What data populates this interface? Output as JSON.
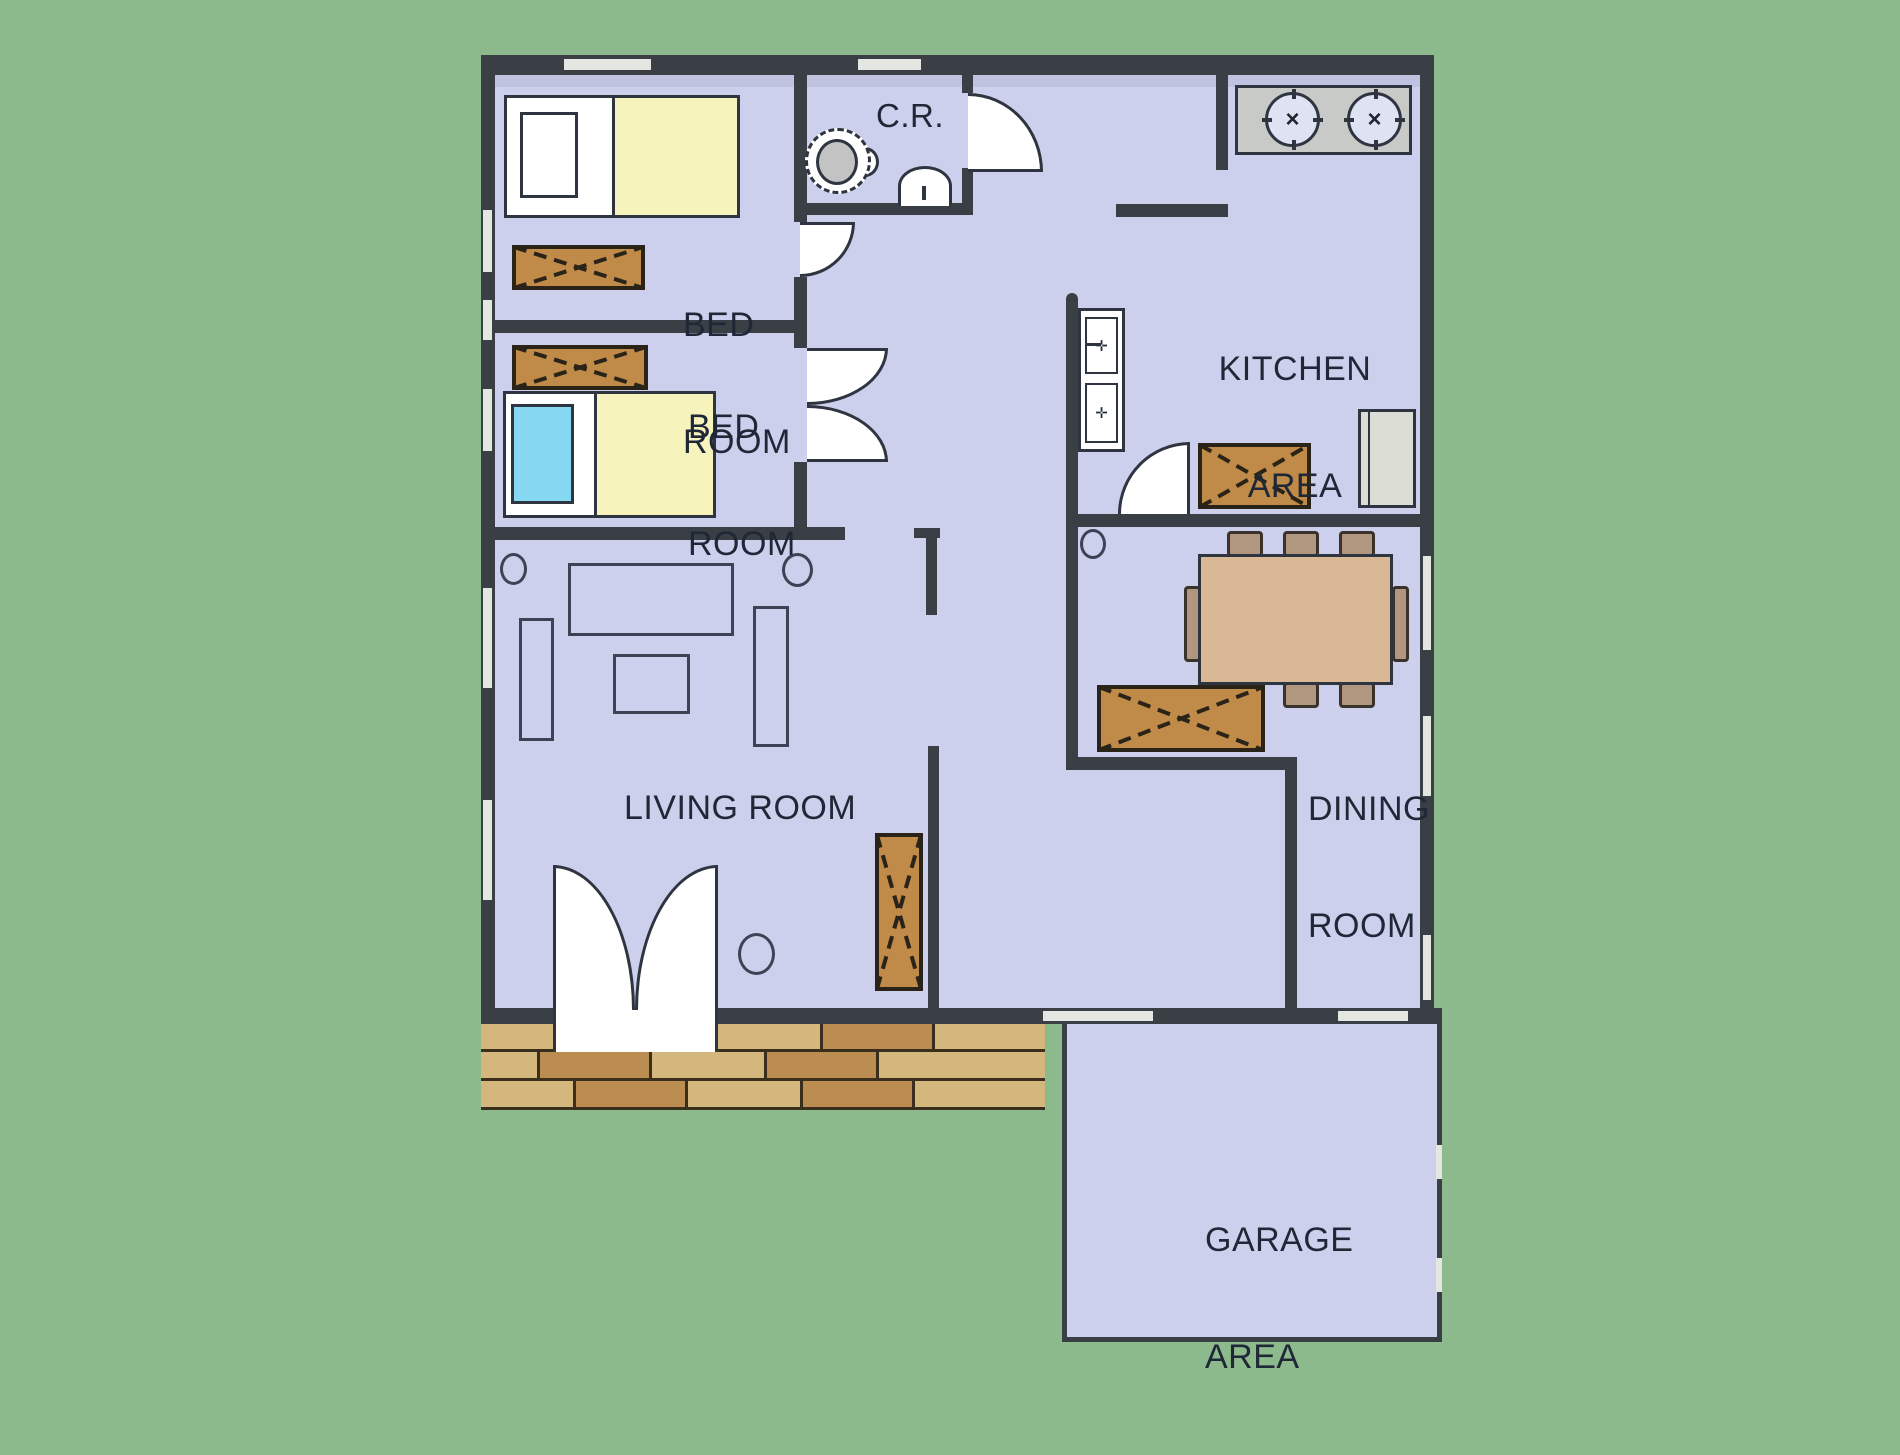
{
  "labels": {
    "bedroom1": {
      "line1": "BED",
      "line2": "ROOM"
    },
    "bedroom2": {
      "line1": "BED",
      "line2": "ROOM"
    },
    "cr": "C.R.",
    "kitchen": {
      "line1": "KITCHEN",
      "line2": "AREA"
    },
    "living": "LIVING ROOM",
    "dining": {
      "line1": "DINING",
      "line2": "ROOM"
    },
    "garage": {
      "line1": "GARAGE",
      "line2": "AREA"
    }
  },
  "stove": {
    "burner_glyph": "×"
  },
  "kitchen_sink": {
    "upper_basin_glyph": "✛",
    "lower_basin_glyph": "✛"
  },
  "colors": {
    "green": "#8CBA8D",
    "floor": "#CDD0EC",
    "wall": "#3A3F45",
    "window": "#E3E6E1",
    "line": "#2E3440",
    "wood": "#C08A48",
    "woodline": "#2A2318",
    "yellow": "#F6F3BD",
    "cyan": "#86D7F2",
    "tabletan": "#D9B896",
    "chair": "#B1977F",
    "appliance": "#C8CAC7",
    "fridge": "#DCDED6",
    "bricktan": "#D4B77C",
    "brickbrown": "#BB8D50",
    "brickline": "#3A2E1C",
    "text": "#1F2836",
    "toiletgray": "#C3C3C3"
  }
}
